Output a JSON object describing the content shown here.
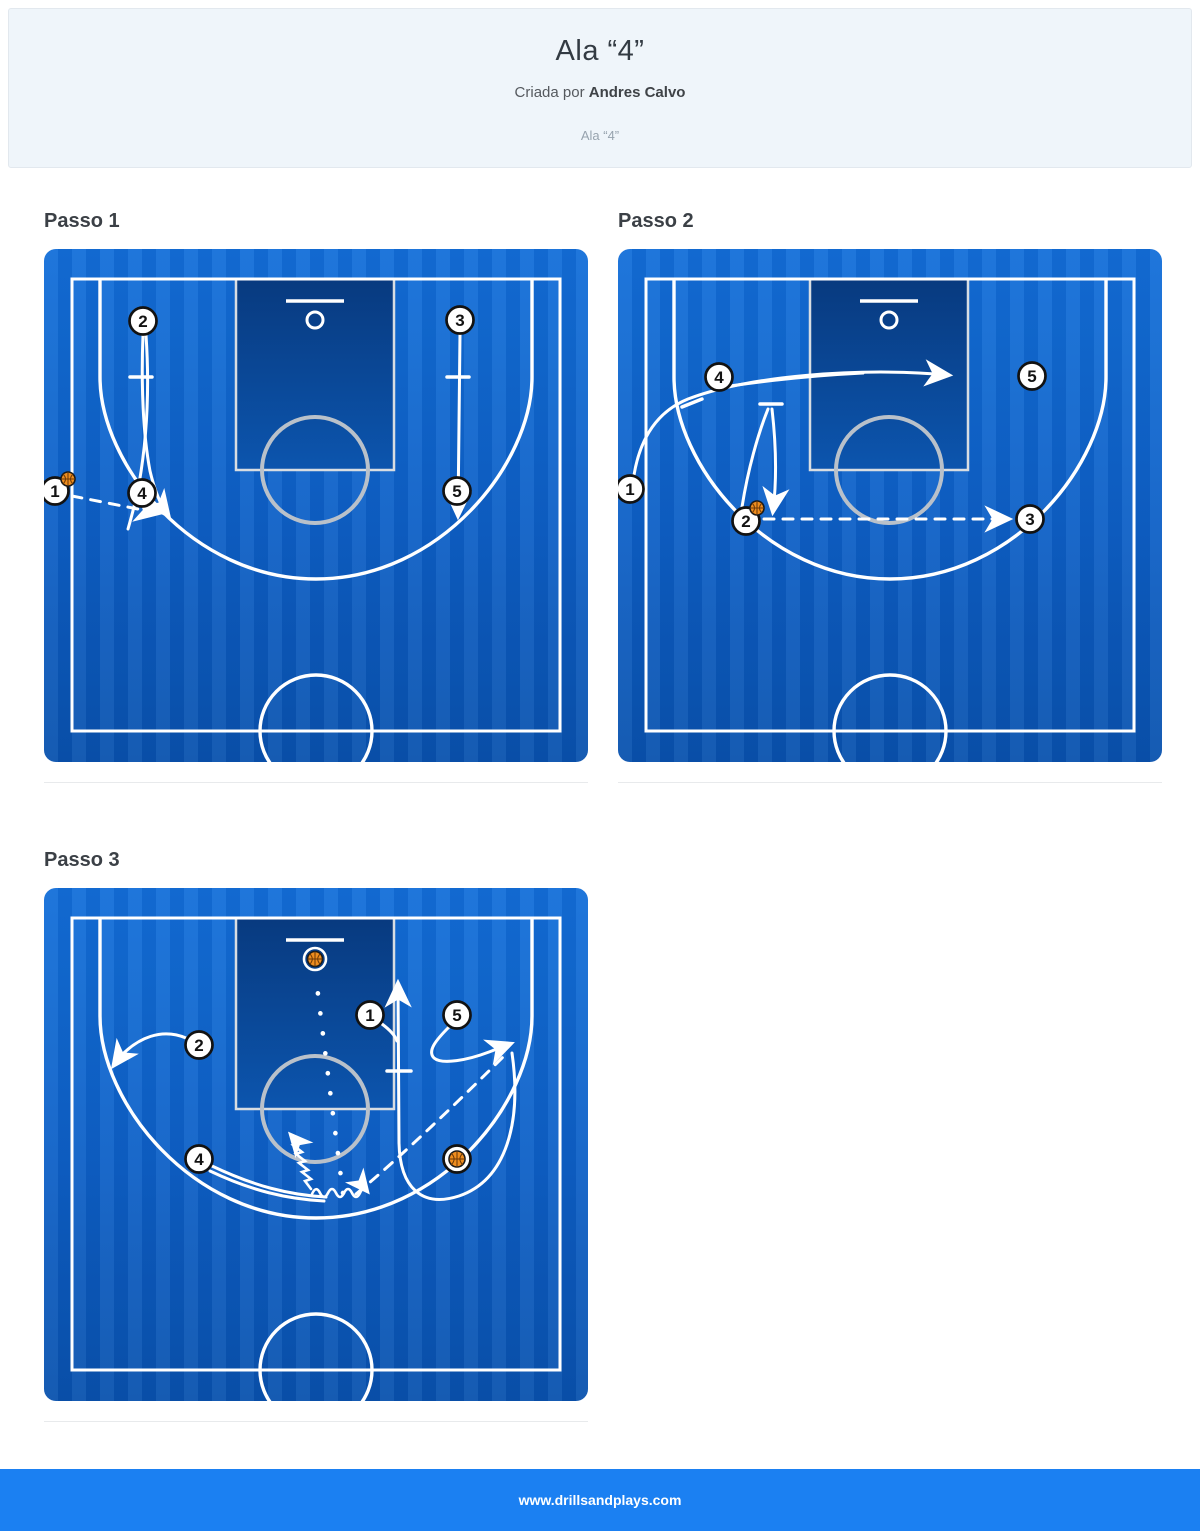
{
  "header": {
    "title": "Ala “4”",
    "byline_prefix": "Criada por ",
    "author": "Andres Calvo",
    "subtitle": "Ala “4”"
  },
  "footer": {
    "url": "www.drillsandplays.com"
  },
  "colors": {
    "court_top": "#136fd9",
    "court_mid": "#0e60c6",
    "court_bottom": "#0a52ae",
    "paint_top": "#083a7f",
    "paint_bottom": "#0c55ae",
    "line_white": "#ffffff",
    "ft_circle_gray": "#b9c1ca",
    "ball_orange": "#ee8d1f",
    "footer_blue": "#1b80f2",
    "header_bg": "#eff5fa"
  },
  "steps": [
    {
      "label": "Passo 1",
      "diagram": {
        "players": [
          {
            "n": "2",
            "x": 99,
            "y": 72
          },
          {
            "n": "3",
            "x": 416,
            "y": 71
          },
          {
            "n": "1",
            "x": 11,
            "y": 242
          },
          {
            "n": "4",
            "x": 98,
            "y": 244
          },
          {
            "n": "5",
            "x": 413,
            "y": 242
          }
        ],
        "ball_chips": [
          {
            "x": 24,
            "y": 230
          }
        ],
        "ball_markers": [],
        "rim_ball": null,
        "screens": [
          "M86 128 L108 128",
          "M403 128 L425 128"
        ],
        "cuts": [
          {
            "d": "M99 86 C97 135 99 185 106 222 C111 243 117 257 124 266",
            "arrow": true
          },
          {
            "d": "M102 86 C106 145 102 195 95 235 C92 252 88 266 84 280",
            "arrow": false
          },
          {
            "d": "M416 85 L414 266",
            "arrow": true
          }
        ],
        "passes": [
          {
            "d": "M28 247 L114 264",
            "arrow": true
          }
        ],
        "dribbles": [],
        "shots": []
      }
    },
    {
      "label": "Passo 2",
      "diagram": {
        "players": [
          {
            "n": "4",
            "x": 101,
            "y": 128
          },
          {
            "n": "5",
            "x": 414,
            "y": 127
          },
          {
            "n": "1",
            "x": 12,
            "y": 240
          },
          {
            "n": "2",
            "x": 128,
            "y": 272
          },
          {
            "n": "3",
            "x": 412,
            "y": 270
          }
        ],
        "ball_chips": [
          {
            "x": 139,
            "y": 259
          }
        ],
        "ball_markers": [],
        "rim_ball": null,
        "screens": [
          "M64 158 L84 150",
          "M142 155 L164 155"
        ],
        "cuts": [
          {
            "d": "M16 226 C22 190 38 163 70 150 C130 127 240 118 330 126",
            "arrow": true
          },
          {
            "d": "M112 137 C160 130 205 126 245 124",
            "arrow": false
          },
          {
            "d": "M124 258 C130 220 140 185 150 160",
            "arrow": false
          },
          {
            "d": "M154 160 C158 195 159 230 155 262",
            "arrow": true
          }
        ],
        "passes": [
          {
            "d": "M146 270 L390 270",
            "arrow": true
          }
        ],
        "dribbles": [],
        "shots": []
      }
    },
    {
      "label": "Passo 3",
      "diagram": {
        "players": [
          {
            "n": "1",
            "x": 326,
            "y": 127
          },
          {
            "n": "5",
            "x": 413,
            "y": 127
          },
          {
            "n": "2",
            "x": 155,
            "y": 157
          },
          {
            "n": "4",
            "x": 155,
            "y": 271
          }
        ],
        "ball_chips": [],
        "ball_markers": [
          {
            "x": 413,
            "y": 271
          }
        ],
        "rim_ball": {
          "x": 271,
          "y": 71
        },
        "screens": [
          "M343 183 L367 183"
        ],
        "cuts": [
          {
            "d": "M468 165 C478 235 462 292 415 308 C378 320 356 300 355 255 L354 96",
            "arrow": true
          },
          {
            "d": "M338 136 C346 142 351 147 353 153",
            "arrow": false
          },
          {
            "d": "M405 139 C392 152 383 163 390 170 C398 177 424 172 445 164 L466 156",
            "arrow": true
          },
          {
            "d": "M142 150 C118 140 94 149 75 170 L70 177",
            "arrow": true
          },
          {
            "d": "M168 278 C210 298 245 307 282 309",
            "arrow": false
          },
          {
            "d": "M166 283 C208 303 243 311 280 313",
            "arrow": false
          }
        ],
        "passes": [
          {
            "d": "M312 306 C358 268 420 208 462 166",
            "arrow": false
          }
        ],
        "dribbles": [
          {
            "d": "M268 306 q4 -9 8 -1 q4 8 8 0 q4 -8 8 0 q4 8 8 0 q4 -8 8 0 q4 8 8 0 q3 -7 7 -2",
            "arrow": true
          },
          {
            "d": "M267 301 l-6 -8 l6 -2 l-9 -7 l6 -2 l-9 -7 l6 -2 l-9 -7 l6 -2 l-9 -7 l5 -2 l-7 -8",
            "arrow": true
          }
        ],
        "shots": [
          {
            "d": "M299 305 C290 235 280 155 272 90"
          }
        ]
      }
    }
  ]
}
